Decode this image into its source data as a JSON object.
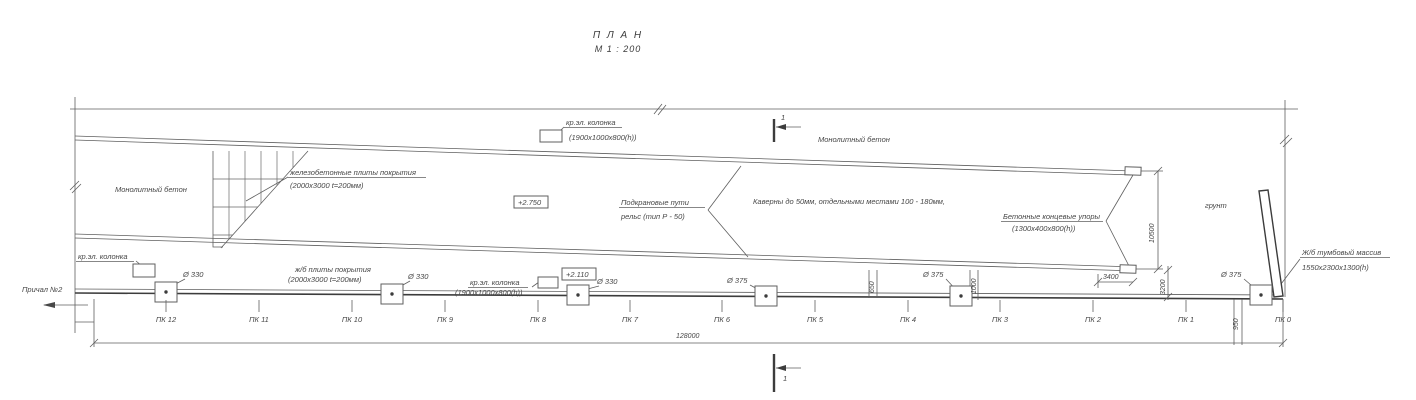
{
  "title": {
    "line1": "П Л А Н",
    "line2": "М 1 : 200"
  },
  "colors": {
    "background": "#ffffff",
    "line": "#5f5f5f",
    "line_dark": "#3c3c3c",
    "text": "#474747"
  },
  "annotations": [
    {
      "name": "crane-column-top-label",
      "text": "кр.эл. колонка",
      "x": 566,
      "y": 125,
      "underline": 58
    },
    {
      "name": "crane-column-top-size",
      "text": "(1900x1000x800(h))",
      "x": 569,
      "y": 140
    },
    {
      "name": "monolith-concrete-left-label",
      "text": "Монолитный бетон",
      "x": 115,
      "y": 192
    },
    {
      "name": "monolith-concrete-right-label",
      "text": "Монолитный бетон",
      "x": 818,
      "y": 142
    },
    {
      "name": "precast-slabs-label",
      "text": "железобетонные плиты покрытия",
      "x": 290,
      "y": 175,
      "underline": 138
    },
    {
      "name": "precast-slabs-size",
      "text": "(2000x3000  t=200мм)",
      "x": 290,
      "y": 188
    },
    {
      "name": "elevation-2750",
      "text": "+2.750",
      "x": 518,
      "y": 205,
      "box": true
    },
    {
      "name": "crane-rails-label-line1",
      "text": "Подкрановые пути",
      "x": 621,
      "y": 205,
      "underline": 86
    },
    {
      "name": "crane-rails-label-line2",
      "text": "рельс (тип  Р - 50)",
      "x": 621,
      "y": 219
    },
    {
      "name": "caverns-note",
      "text": "Каверны до 50мм, отдельными местами 100 - 180мм,",
      "x": 753,
      "y": 204
    },
    {
      "name": "end-stops-label",
      "text": "Бетонные концевые упоры",
      "x": 1003,
      "y": 219,
      "underline": 102
    },
    {
      "name": "end-stops-size",
      "text": "(1300x400x800(h))",
      "x": 1012,
      "y": 231
    },
    {
      "name": "soil-label",
      "text": "грунт",
      "x": 1205,
      "y": 208
    },
    {
      "name": "mooring-massif-label",
      "text": "Ж/б тумбовый массив",
      "x": 1302,
      "y": 255,
      "underline": 90
    },
    {
      "name": "mooring-massif-size",
      "text": "1550x2300x1300(h)",
      "x": 1302,
      "y": 270
    },
    {
      "name": "berth-label",
      "text": "Причал №2",
      "x": 22,
      "y": 292
    },
    {
      "name": "crane-column-bottomleft-label",
      "text": "кр.эл. колонка",
      "x": 78,
      "y": 259,
      "underline": 58
    },
    {
      "name": "slabs-bottom-label",
      "text": "ж/б плиты покрытия",
      "x": 295,
      "y": 272
    },
    {
      "name": "slabs-bottom-size",
      "text": "(2000x3000 t=200мм)",
      "x": 288,
      "y": 282
    },
    {
      "name": "crane-column-bottommid-label",
      "text": "кр.эл. колонка",
      "x": 470,
      "y": 285,
      "underline": 60
    },
    {
      "name": "crane-column-bottommid-size",
      "text": "(1900x1000x800(h))",
      "x": 455,
      "y": 295
    },
    {
      "name": "elevation-2110",
      "text": "+2.110",
      "x": 566,
      "y": 277,
      "box": true
    },
    {
      "name": "section-mark-top-number",
      "text": "1",
      "x": 781,
      "y": 120
    },
    {
      "name": "section-mark-bottom-number",
      "text": "1",
      "x": 783,
      "y": 381
    }
  ],
  "bollards": [
    {
      "name": "bollard-pk12",
      "x": 166,
      "cy": 292,
      "label": "Ø 330",
      "lx": 183,
      "ly": 277
    },
    {
      "name": "bollard-pk10-9",
      "x": 392,
      "cy": 294,
      "label": "Ø 330",
      "lx": 408,
      "ly": 279
    },
    {
      "name": "bollard-pk8-7",
      "x": 578,
      "cy": 295,
      "label": "Ø 330",
      "lx": 597,
      "ly": 284
    },
    {
      "name": "bollard-pk6-5",
      "x": 766,
      "cy": 296,
      "label": "Ø 375",
      "lx": 727,
      "ly": 283
    },
    {
      "name": "bollard-pk4-3",
      "x": 961,
      "cy": 296,
      "label": "Ø 375",
      "lx": 923,
      "ly": 277
    },
    {
      "name": "bollard-pk0",
      "x": 1261,
      "cy": 295,
      "label": "Ø 375",
      "lx": 1221,
      "ly": 277
    }
  ],
  "stations": {
    "label_y": 322,
    "tick_y1": 300,
    "tick_y2": 312,
    "items": [
      {
        "label": "ПК 12",
        "x": 166
      },
      {
        "label": "ПК 11",
        "x": 259
      },
      {
        "label": "ПК 10",
        "x": 352
      },
      {
        "label": "ПК 9",
        "x": 445
      },
      {
        "label": "ПК 8",
        "x": 538
      },
      {
        "label": "ПК 7",
        "x": 630
      },
      {
        "label": "ПК 6",
        "x": 722
      },
      {
        "label": "ПК 5",
        "x": 815
      },
      {
        "label": "ПК 4",
        "x": 908
      },
      {
        "label": "ПК 3",
        "x": 1000
      },
      {
        "label": "ПК 2",
        "x": 1093
      },
      {
        "label": "ПК 1",
        "x": 1186
      },
      {
        "label": "ПК 0",
        "x": 1283
      }
    ]
  },
  "dimensions": [
    {
      "name": "dim-10500",
      "text": "10500",
      "x": 1154,
      "y": 243,
      "rot": true
    },
    {
      "name": "dim-3400",
      "text": "3400",
      "x": 1103,
      "y": 279,
      "rot": false
    },
    {
      "name": "dim-3200",
      "text": "3200",
      "x": 1165,
      "y": 295,
      "rot": true
    },
    {
      "name": "dim-1000",
      "text": "1000",
      "x": 976,
      "y": 294,
      "rot": true
    },
    {
      "name": "dim-650",
      "text": "650",
      "x": 874,
      "y": 293,
      "rot": true
    },
    {
      "name": "dim-950",
      "text": "950",
      "x": 1238,
      "y": 330,
      "rot": true
    },
    {
      "name": "dim-128000",
      "text": "128000",
      "x": 676,
      "y": 338,
      "rot": false
    }
  ]
}
